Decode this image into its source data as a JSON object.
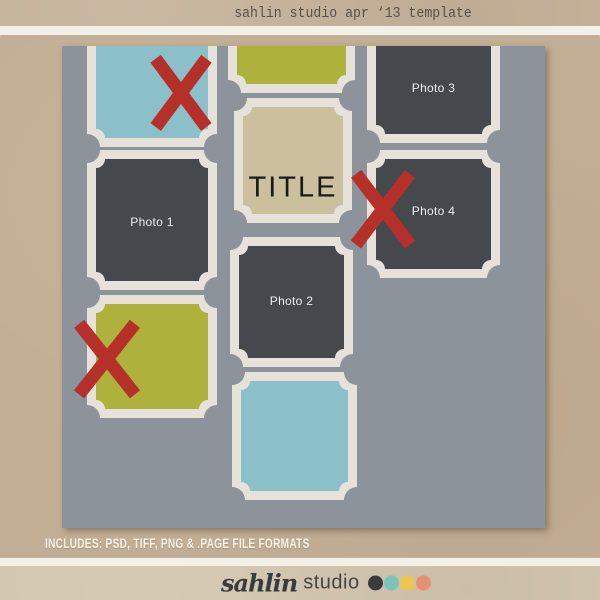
{
  "header": {
    "title": "sahlin studio apr ‘13 template"
  },
  "canvas": {
    "frame_border": 9,
    "corner_radius_outer": 13,
    "corner_radius_inner": 9,
    "x_bar_width": 13,
    "frames": [
      {
        "id": "frame-blue-top-left",
        "x": 25,
        "y": -60,
        "w": 130,
        "h": 161,
        "fill": "blue",
        "label": ""
      },
      {
        "id": "frame-green-top",
        "x": 166,
        "y": -60,
        "w": 127,
        "h": 107,
        "fill": "green",
        "label": ""
      },
      {
        "id": "frame-photo-3",
        "x": 305,
        "y": -60,
        "w": 133,
        "h": 157,
        "fill": "dark",
        "label": "Photo 3",
        "label_cy": 102,
        "variant": "photo"
      },
      {
        "id": "frame-title",
        "x": 172,
        "y": 52,
        "w": 118,
        "h": 125,
        "fill": "tan",
        "label": "TITLE",
        "label_cy": 90,
        "variant": "title"
      },
      {
        "id": "frame-photo-1",
        "x": 25,
        "y": 104,
        "w": 130,
        "h": 140,
        "fill": "dark",
        "label": "Photo 1",
        "label_cy": 72,
        "variant": "photo"
      },
      {
        "id": "frame-photo-4",
        "x": 305,
        "y": 104,
        "w": 133,
        "h": 128,
        "fill": "dark",
        "label": "Photo 4",
        "label_cy": 61,
        "variant": "photo"
      },
      {
        "id": "frame-photo-2",
        "x": 168,
        "y": 191,
        "w": 123,
        "h": 130,
        "fill": "dark",
        "label": "Photo 2",
        "label_cy": 64,
        "variant": "photo"
      },
      {
        "id": "frame-green-bottom",
        "x": 25,
        "y": 249,
        "w": 130,
        "h": 123,
        "fill": "green",
        "label": ""
      },
      {
        "id": "frame-blue-bottom",
        "x": 170,
        "y": 326,
        "w": 125,
        "h": 128,
        "fill": "blue",
        "label": ""
      }
    ],
    "x_marks": [
      {
        "id": "x-mark-top",
        "x": 93,
        "y": 12,
        "w": 52,
        "h": 70
      },
      {
        "id": "x-mark-right",
        "x": 293,
        "y": 127,
        "w": 55,
        "h": 72
      },
      {
        "id": "x-mark-bottom-left",
        "x": 16,
        "y": 277,
        "w": 57,
        "h": 72
      }
    ]
  },
  "footer": {
    "formats_text": "INCLUDES: PSD, TIFF, PNG & .PAGE FILE FORMATS",
    "logo": {
      "script_text": "sahlin",
      "sans_text": "studio",
      "dots": [
        {
          "name": "charcoal",
          "color": "#383c3e"
        },
        {
          "name": "teal",
          "color": "#7cc4ba"
        },
        {
          "name": "yellow",
          "color": "#ecc551"
        },
        {
          "name": "salmon",
          "color": "#e69073"
        }
      ]
    }
  },
  "colors": {
    "kraft_top": "#c7b39b",
    "kraft_main": "#c2ae94",
    "kraft_bottom": "#d3c6b0",
    "white_band": "#f3f0e8",
    "canvas_gray": "#8c939b",
    "frame_white": "#e6e2d9",
    "blue": "#8bbfc9",
    "green": "#aeb23c",
    "tan": "#cbbf9d",
    "dark": "#45484d",
    "red": "#b43029",
    "photo_label": "#eceff1",
    "title_text": "#1a1a1a",
    "header_text": "#57504a",
    "formats_text_color": "#f5f2ea",
    "logo_text": "#383c3f"
  }
}
